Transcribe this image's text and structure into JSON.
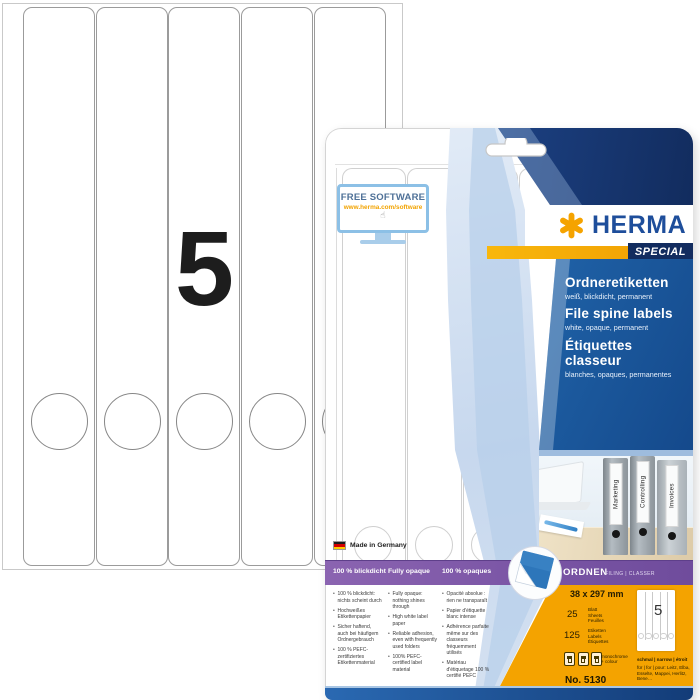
{
  "product": {
    "sheet_big_digit": "5",
    "brand": "HERMA",
    "range_badge": "SPECIAL",
    "free_software": {
      "title": "FREE SOFTWARE",
      "url": "www.herma.com/software"
    },
    "titles": {
      "de": {
        "name": "Ordneretiketten",
        "desc": "weiß, blickdicht, permanent"
      },
      "en": {
        "name": "File spine labels",
        "desc": "white, opaque, permanent"
      },
      "fr": {
        "name": "Étiquettes classeur",
        "desc": "blanches, opaques, permanentes"
      }
    },
    "binders": [
      "Marketing",
      "Controlling",
      "Invoices"
    ],
    "made_in": "Made in Germany",
    "band": {
      "de": "100 % blickdicht",
      "en": "Fully opaque",
      "fr": "100 % opaques",
      "category": "ORDNEN",
      "category_sub": "FILING | CLASSER"
    },
    "features": {
      "de": [
        "100 % blickdicht: nichts scheint durch",
        "Hochweißes Etikettenpapier",
        "Sicher haftend, auch bei häufigem Ordnergebrauch",
        "100 % PEFC-zertifiziertes Etikettenmaterial"
      ],
      "en": [
        "Fully opaque: nothing shines through",
        "High white label paper",
        "Reliable adhesion, even with frequently used folders",
        "100% PEFC-certified label material"
      ],
      "fr": [
        "Opacité absolue : rien ne transparaît",
        "Papier d'étiquette blanc intense",
        "Adhérence parfaite même sur des classeurs fréquemment utilisés",
        "Matériau d'étiquetage 100 % certifié PEFC"
      ]
    },
    "specs": {
      "size": "38 x 297 mm",
      "sheets": "25",
      "sheets_units": {
        "de": "Blatt",
        "en": "Sheets",
        "fr": "Feuilles"
      },
      "labels": "125",
      "labels_units": {
        "de": "Etiketten",
        "en": "Labels",
        "fr": "Étiquettes"
      },
      "print": "monochrome + colour",
      "diagram_digit": "5",
      "format_note": "schmal | narrow | étroit",
      "compatibility": "für | for | pour: Leitz, Elba, Esselte, Mappei, Herlitz, Bene…",
      "order_no": "No. 5130"
    },
    "icons": {
      "hand_cursor": "☝"
    },
    "colors": {
      "herma_blue": "#1e4e9b",
      "accent_orange": "#f5a300",
      "navy": "#122c5e",
      "panel_blue": "#2268ae",
      "purple": "#7a55a5",
      "yellow": "#f4a300"
    }
  }
}
